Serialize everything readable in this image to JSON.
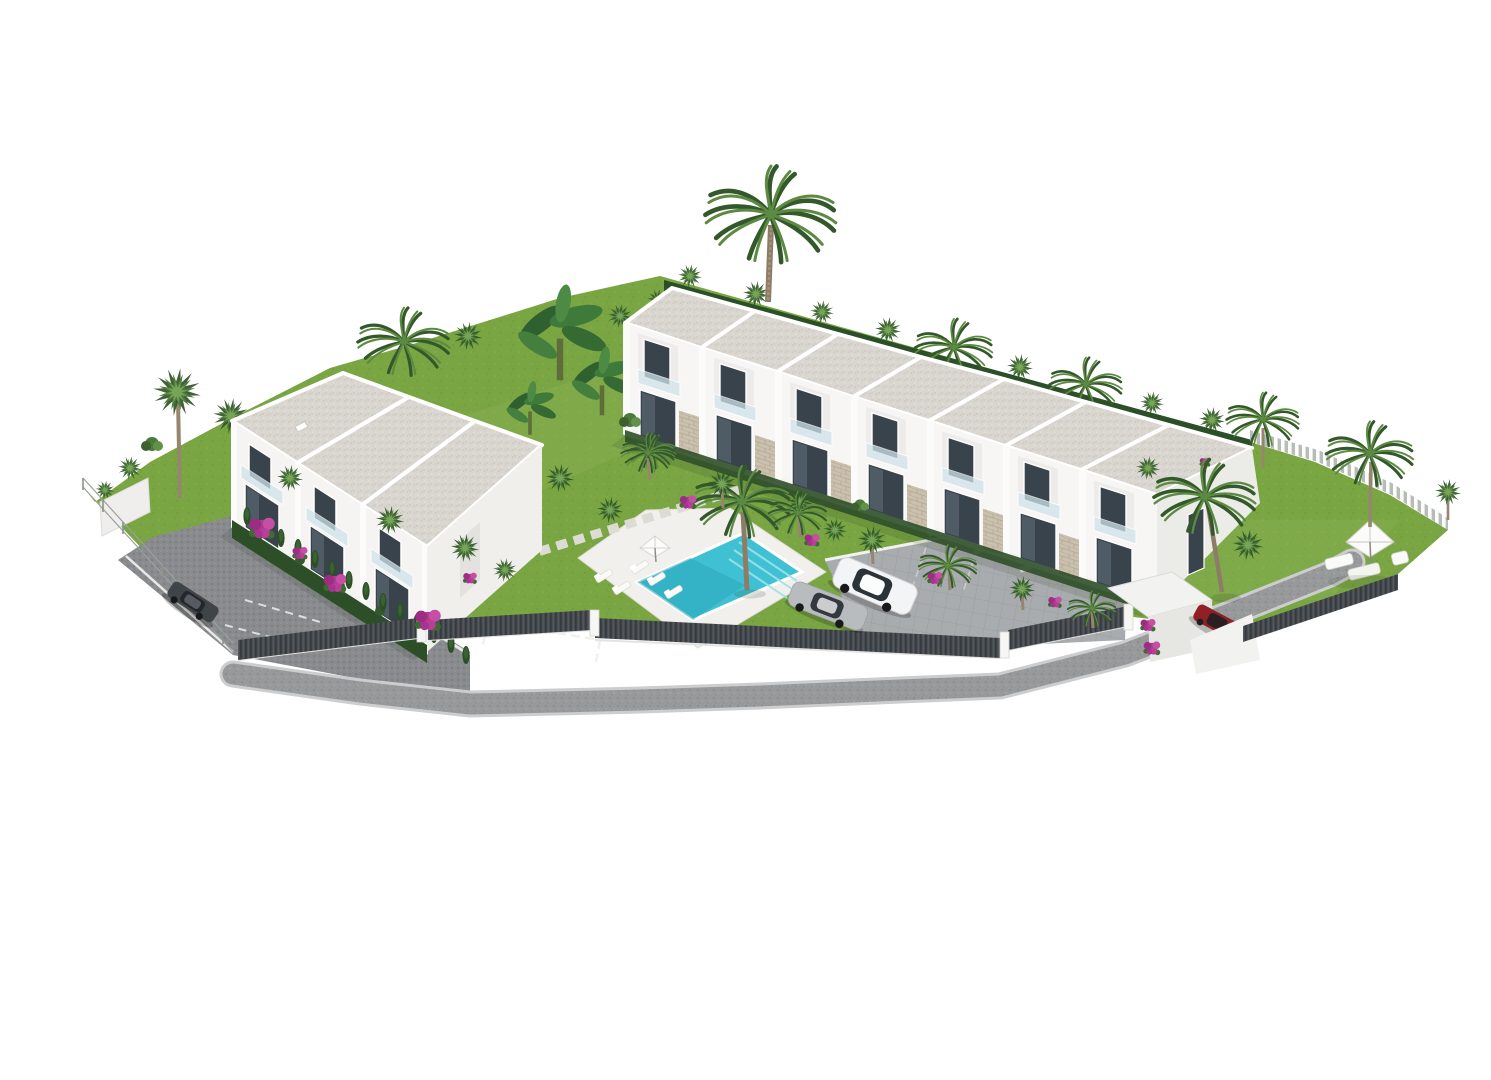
{
  "scene": {
    "type": "architectural-3d-render",
    "setting": "aerial view of a white townhouse complex with pool and gardens on a plain white background",
    "buildings": {
      "left_block": {
        "label": "left-townhouse-block",
        "units": 3,
        "storeys": 2,
        "roof": "flat gravel"
      },
      "right_row": {
        "label": "townhouse-row",
        "units": 7,
        "storeys": 2,
        "roof": "flat gravel stepped"
      }
    },
    "amenities": {
      "swimming_pool": true,
      "sun_loungers": 5,
      "pool_parasols": 1,
      "garden_parasols": 1,
      "garden_sofa_set": true
    },
    "vehicles": [
      {
        "name": "dark-hatchback",
        "color": "#3f4449",
        "location": "left driveway"
      },
      {
        "name": "white-suv",
        "color": "#f3f4f6",
        "location": "central parking"
      },
      {
        "name": "silver-sedan",
        "color": "#b9bcbe",
        "location": "central parking"
      },
      {
        "name": "red-car",
        "color": "#8e2026",
        "location": "right gate"
      }
    ],
    "vegetation": {
      "date_palms": true,
      "fan_palms": true,
      "banana_plants": true,
      "bougainvillea": true,
      "cypress_hedges": true,
      "lawns": true
    },
    "boundaries": {
      "corrugated_metal_fence": true,
      "white_retaining_wall": true,
      "white_picket_fence": true,
      "wire_mesh_fence": true,
      "access_road": "curved gravel road along bottom"
    }
  },
  "colors": {
    "background": "#ffffff",
    "lawn": "#79a542",
    "lawn_light": "#8ab254",
    "hedge": "#2d4f28",
    "palm_dark": "#2f5527",
    "palm_mid": "#4e7a3c",
    "palm_light": "#79a758",
    "trunk": "#96866f",
    "bougainvillea": "#b13a92",
    "roof_base": "#d9d5cf",
    "wall_white": "#f6f6f4",
    "wall_shade": "#e9e8e5",
    "glass": "#39434b",
    "glass_light": "#55636d",
    "balustrade": "#cfe3ea",
    "pool_water": "#3fc1d3",
    "pool_deep": "#2ba6bb",
    "deck": "#f1f0ec",
    "paver": "#a9acae",
    "cobble": "#898b8e",
    "road": "#98999b",
    "curb": "#cccdce",
    "fence_dark": "#474b50",
    "stone": "#cac0ae",
    "picket": "#b7bcb8"
  }
}
